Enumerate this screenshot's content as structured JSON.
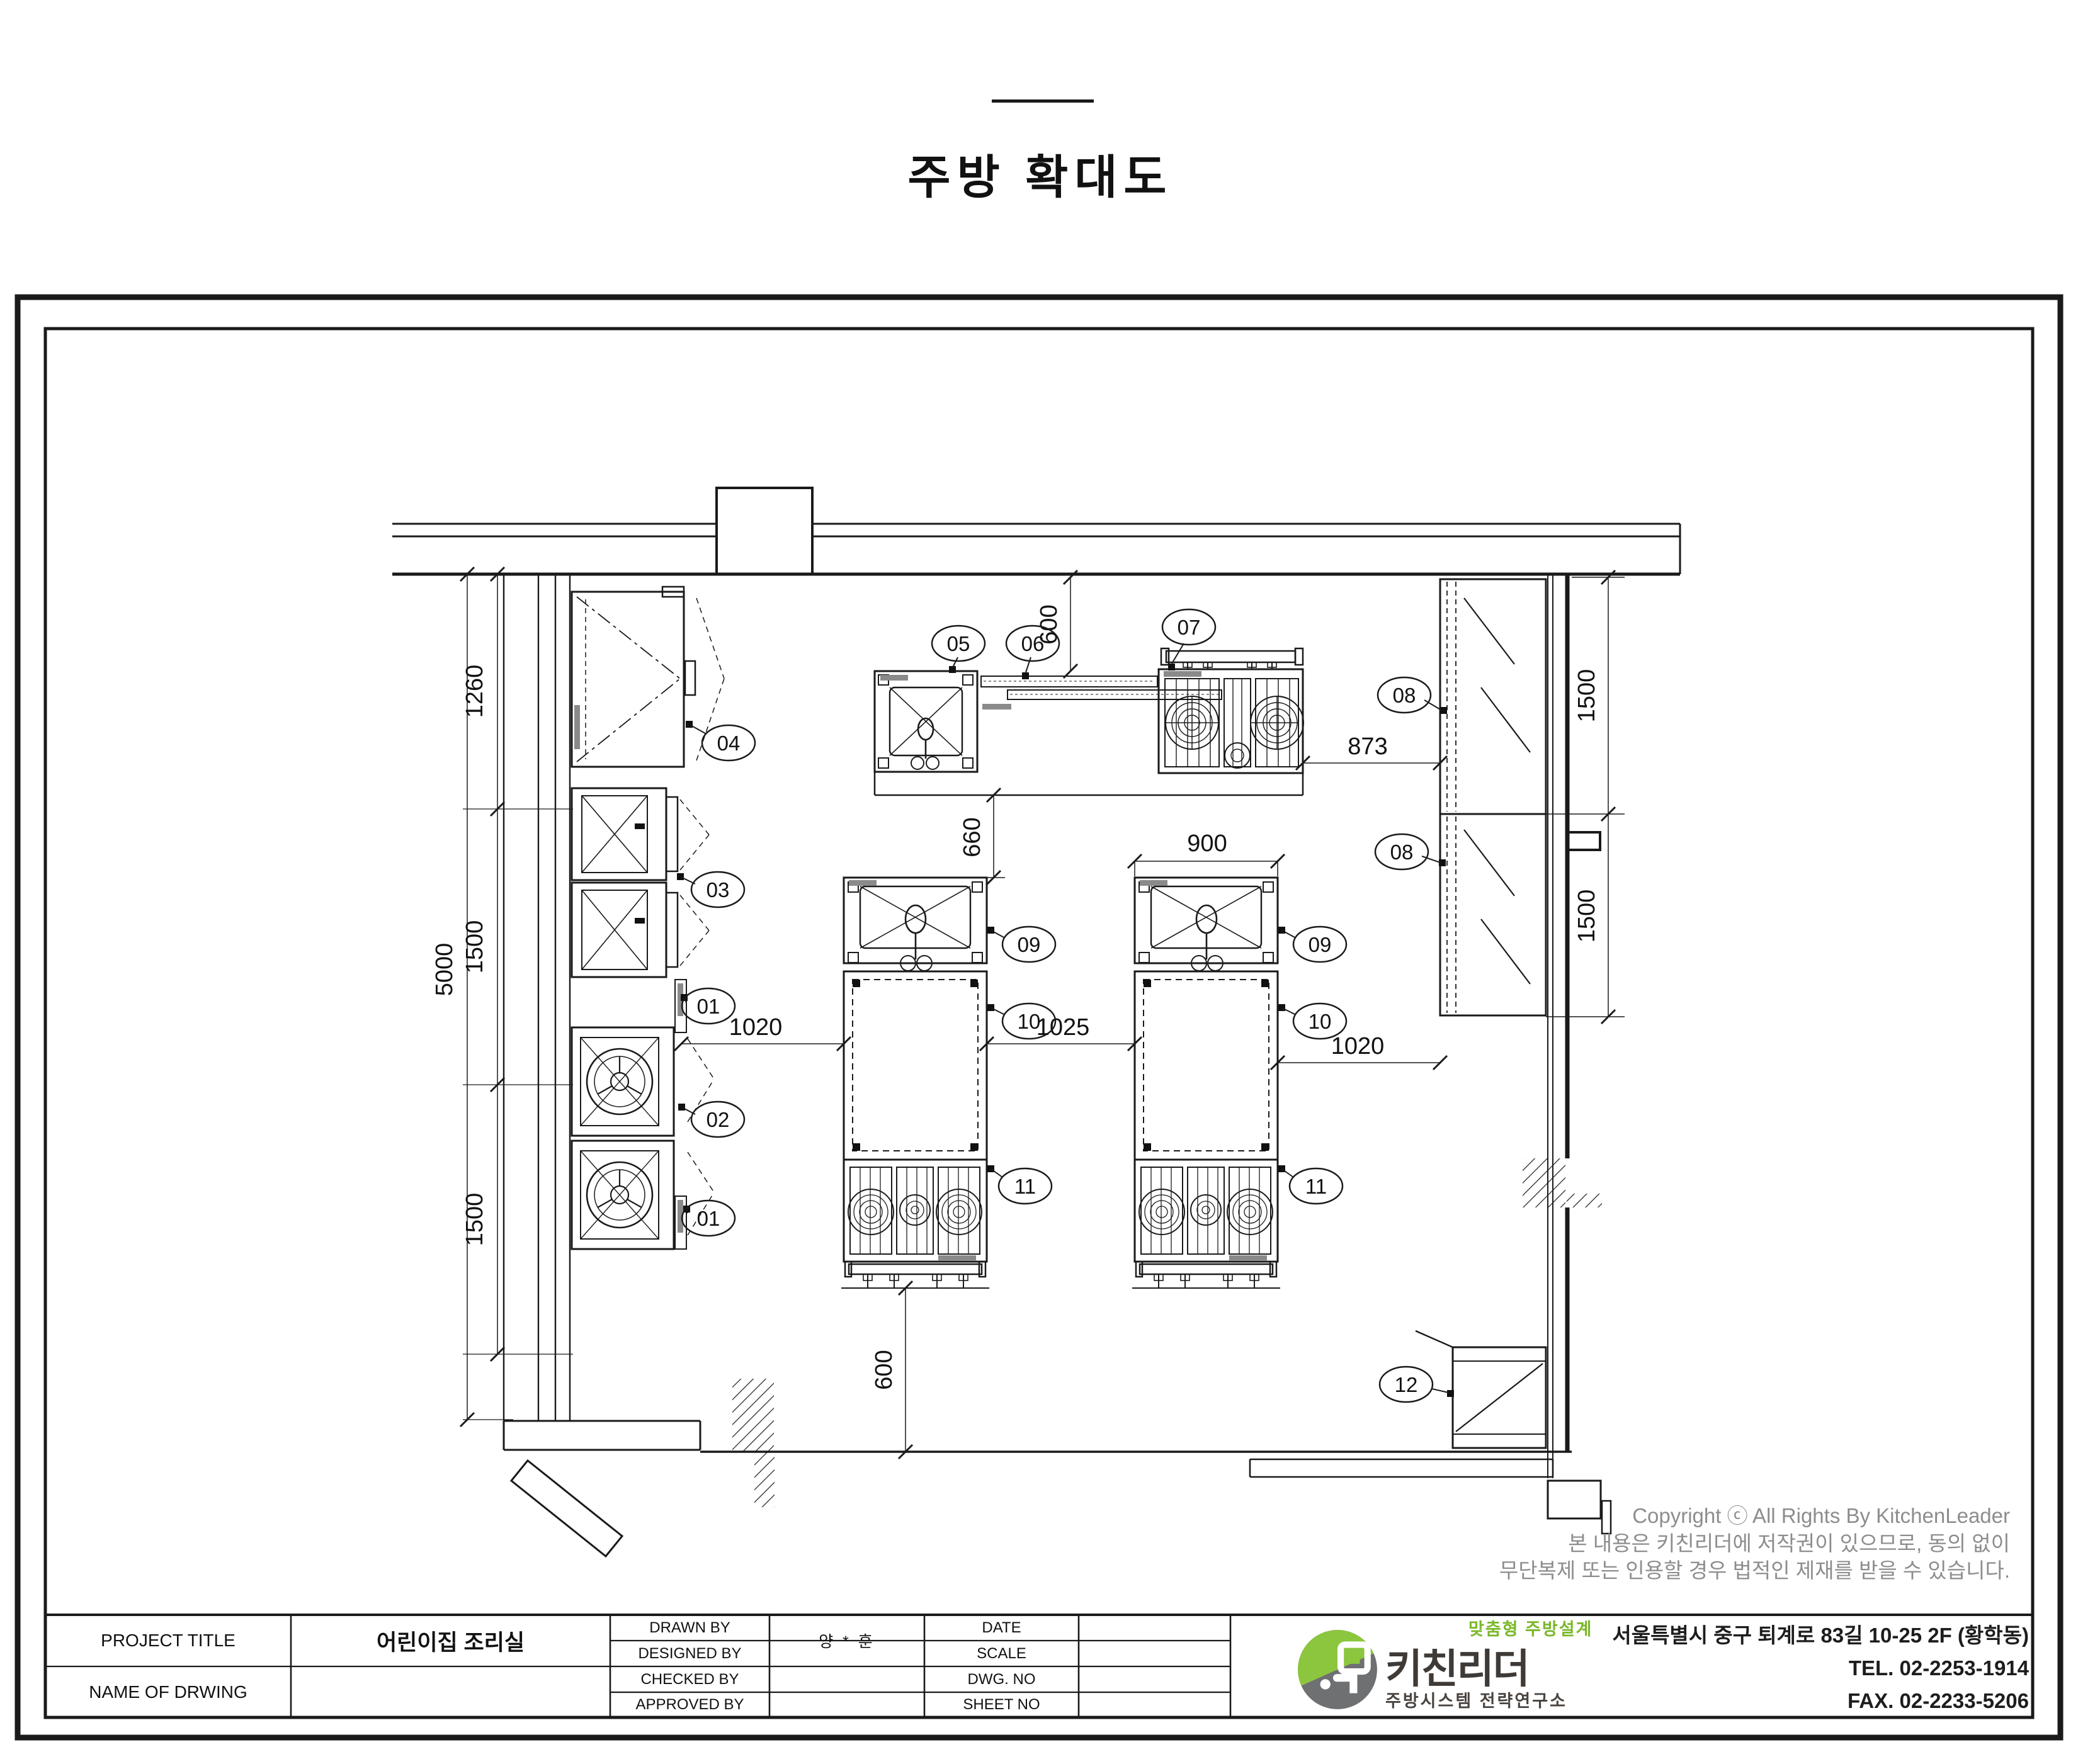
{
  "page": {
    "title": "주방 확대도"
  },
  "plan": {
    "dims": [
      "1260",
      "1500",
      "1500",
      "5000",
      "600",
      "660",
      "873",
      "900",
      "1500",
      "1500",
      "1020",
      "1025",
      "1020",
      "600"
    ],
    "callouts": [
      "04",
      "03",
      "01",
      "02",
      "01",
      "05",
      "06",
      "07",
      "08",
      "08",
      "09",
      "10",
      "11",
      "09",
      "10",
      "11",
      "12"
    ],
    "copyright": {
      "line1": "Copyright ⓒ All Rights By KitchenLeader",
      "line2": "본 내용은 키친리더에 저작권이 있으므로, 동의 없이",
      "line3": "무단복제 또는 인용할 경우 법적인 제재를 받을 수 있습니다."
    }
  },
  "title_block": {
    "project_title_label": "PROJECT TITLE",
    "project_title_value": "어린이집 조리실",
    "name_of_drwing_label": "NAME OF DRWING",
    "drawn_by_label": "DRAWN BY",
    "designed_by_label": "DESIGNED BY",
    "checked_by_label": "CHECKED BY",
    "approved_by_label": "APPROVED BY",
    "designer_value": "양 * 훈",
    "date_label": "DATE",
    "scale_label": "SCALE",
    "dwg_no_label": "DWG. NO",
    "sheet_no_label": "SHEET NO"
  },
  "logo": {
    "brand": "키친리더",
    "tagline": "맞춤형 주방설계",
    "subtitle": "주방시스템 전략연구소",
    "address": "서울특별시 중구 퇴계로 83길 10-25 2F (황학동)",
    "tel": "TEL. 02-2253-1914",
    "fax": "FAX. 02-2233-5206",
    "colors": {
      "green": "#8cc63e",
      "gray": "#6f7072",
      "dark": "#3f3a36"
    }
  }
}
